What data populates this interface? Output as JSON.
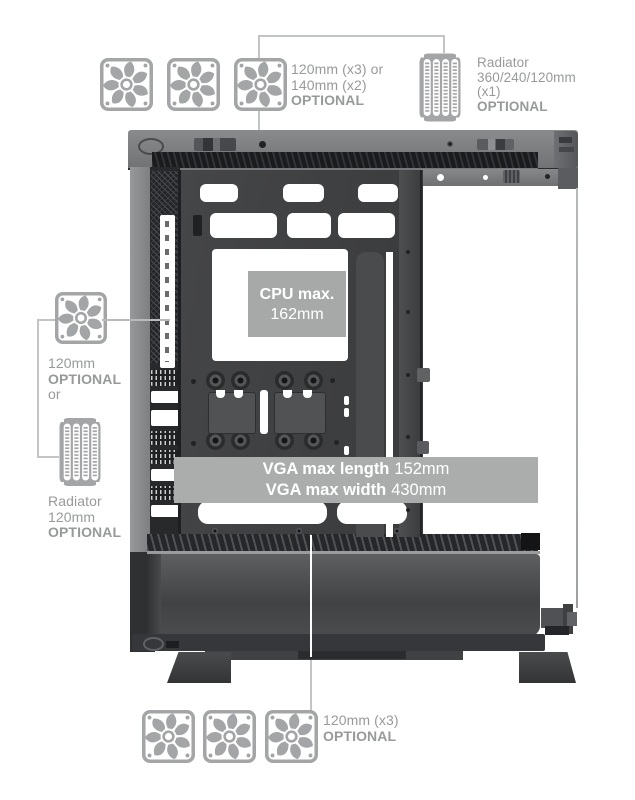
{
  "annotations": {
    "top_fans": {
      "line1": "120mm (x3) or",
      "line2": "140mm (x2)",
      "optional": "OPTIONAL"
    },
    "top_radiator": {
      "title": "Radiator",
      "sizes": "360/240/120mm",
      "qty": "(x1)",
      "optional": "OPTIONAL"
    },
    "left_fan": {
      "size": "120mm",
      "optional": "OPTIONAL",
      "or": "or"
    },
    "left_radiator": {
      "title": "Radiator",
      "size": "120mm",
      "optional": "OPTIONAL"
    },
    "bottom_fans": {
      "size": "120mm (x3)",
      "optional": "OPTIONAL"
    }
  },
  "case": {
    "cpu_label": {
      "title": "CPU max.",
      "value": "162mm"
    },
    "vga_label": {
      "length_label": "VGA max length",
      "length_value": "152mm",
      "width_label": "VGA max width",
      "width_value": "430mm"
    }
  },
  "icons": {
    "fan": "fan-icon",
    "radiator": "radiator-icon"
  },
  "colors": {
    "annotation_text": "#98999b",
    "icon_gray": "#a4a5a7",
    "connector_line": "#c3c4c4",
    "banner_bg": "#abadad",
    "cpu_plate_bg": "#a7a9a9",
    "label_text": "#ffffff",
    "case_body": "#3e3f41"
  }
}
